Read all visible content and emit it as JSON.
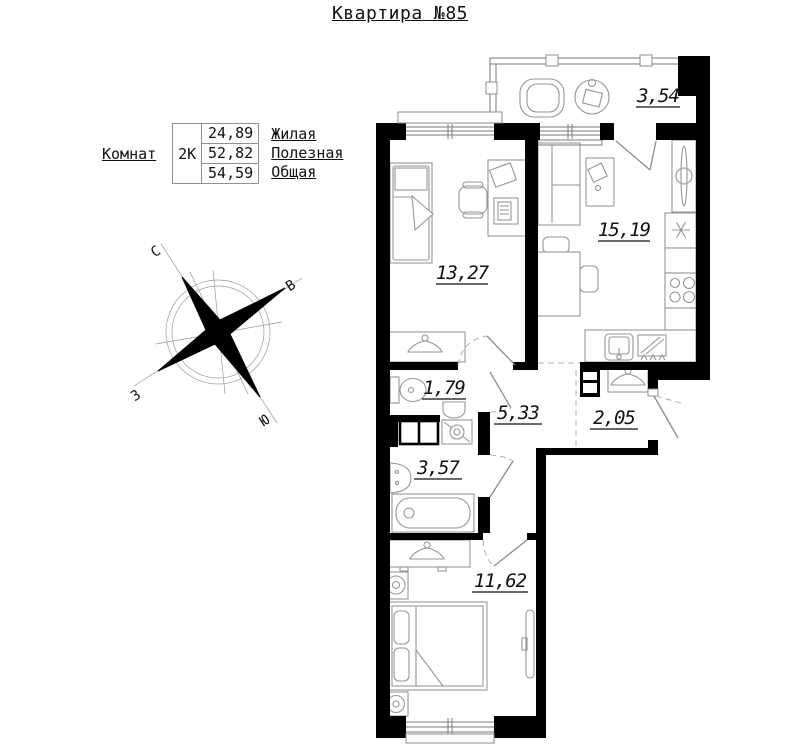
{
  "title": "Квартира №85",
  "info_table": {
    "row_label": "Комнат",
    "type": "2К",
    "areas": [
      {
        "value": "24,89",
        "label": "Жилая"
      },
      {
        "value": "52,82",
        "label": "Полезная"
      },
      {
        "value": "54,59",
        "label": "Общая"
      }
    ]
  },
  "compass": {
    "n": "С",
    "e": "В",
    "w": "З",
    "s": "Ю"
  },
  "rooms": {
    "balcony": "3,54",
    "room1": "13,27",
    "kitchen": "15,19",
    "wc": "1,79",
    "hallway": "5,33",
    "closet": "2,05",
    "bathroom": "3,57",
    "bedroom": "11,62"
  },
  "colors": {
    "wall": "#000000",
    "furniture_line": "#969696",
    "text": "#111111"
  }
}
